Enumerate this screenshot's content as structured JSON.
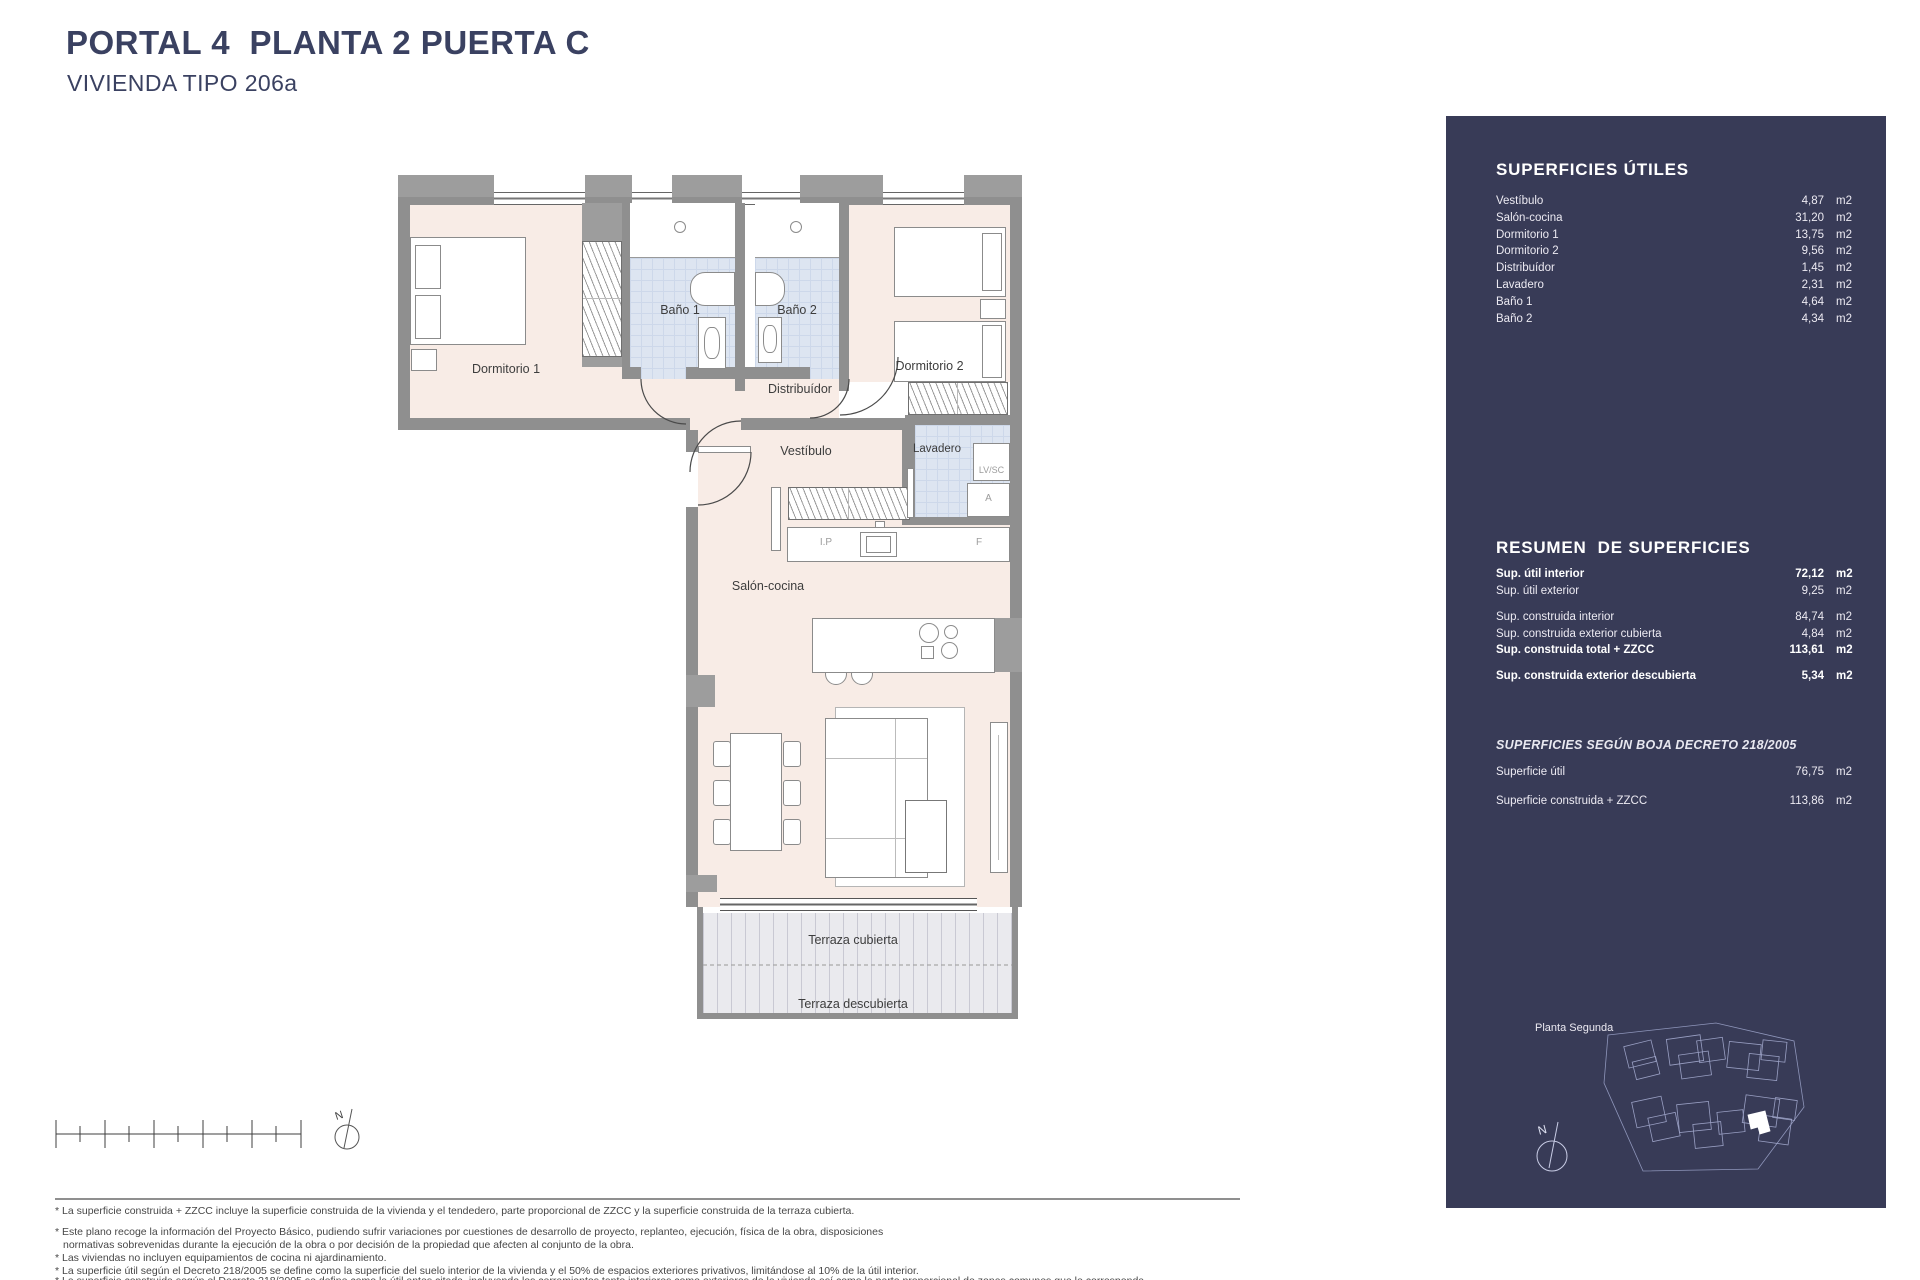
{
  "header": {
    "title": "PORTAL 4  PLANTA 2 PUERTA C",
    "subtitle": "VIVIENDA TIPO 206a"
  },
  "plan": {
    "labels": {
      "dormitorio1": "Dormitorio 1",
      "bano1": "Baño 1",
      "bano2": "Baño 2",
      "dormitorio2": "Dormitorio 2",
      "distribuidor": "Distribuídor",
      "vestibulo": "Vestíbulo",
      "lavadero": "Lavadero",
      "salon_cocina": "Salón-cocina",
      "terraza_cubierta": "Terraza cubierta",
      "terraza_descubierta": "Terraza descubierta",
      "lvsc": "LV/SC",
      "acumulador": "A",
      "induccion": "I.P",
      "frigorifico": "F",
      "north": "N"
    }
  },
  "sidebar": {
    "unit": "m2",
    "utiles": {
      "heading": "SUPERFICIES ÚTILES",
      "rows": [
        {
          "label": "Vestíbulo",
          "value": "4,87"
        },
        {
          "label": "Salón-cocina",
          "value": "31,20"
        },
        {
          "label": "Dormitorio 1",
          "value": "13,75"
        },
        {
          "label": "Dormitorio 2",
          "value": "9,56"
        },
        {
          "label": "Distribuídor",
          "value": "1,45"
        },
        {
          "label": "Lavadero",
          "value": "2,31"
        },
        {
          "label": "Baño 1",
          "value": "4,64"
        },
        {
          "label": "Baño 2",
          "value": "4,34"
        }
      ]
    },
    "resumen": {
      "heading": "RESUMEN  DE SUPERFICIES",
      "rows": [
        {
          "label": "Sup. útil interior",
          "value": "72,12"
        },
        {
          "label": "Sup. útil exterior",
          "value": "9,25"
        },
        {
          "label": "Sup. construida interior",
          "value": "84,74"
        },
        {
          "label": "Sup. construida exterior cubierta",
          "value": "4,84"
        },
        {
          "label": "Sup. construida total + ZZCC",
          "value": "113,61"
        },
        {
          "label": "Sup. construida exterior descubierta",
          "value": "5,34"
        }
      ]
    },
    "boja": {
      "heading": "SUPERFICIES SEGÚN BOJA DECRETO 218/2005",
      "rows": [
        {
          "label": "Superficie útil",
          "value": "76,75"
        },
        {
          "label": "Superficie construida + ZZCC",
          "value": "113,86"
        }
      ]
    },
    "minimap": {
      "label": "Planta Segunda",
      "north": "N"
    }
  },
  "footer": {
    "lines": [
      "* La superficie construida + ZZCC incluye la superficie construida de la vivienda y el tendedero, parte proporcional de ZZCC y la superficie construida de la terraza cubierta.",
      "* Este plano recoge la información del Proyecto Básico, pudiendo sufrir variaciones por cuestiones de desarrollo de proyecto, replanteo, ejecución, física de la obra, disposiciones",
      "normativas sobrevenidas durante la ejecución de la obra o por decisión de la propiedad que afecten al conjunto de la obra.",
      "* Las viviendas no incluyen equipamientos de cocina ni ajardinamiento.",
      "* La superficie útil según el Decreto 218/2005 se define como la superficie del suelo interior de la vivienda y el 50% de espacios exteriores privativos, limitándose al 10% de la útil interior.",
      "* La superficie construida según el Decreto 218/2005 se define como la útil antes citada, incluyendo los cerramientos tanto interiores como exteriores de la vivienda así como la parte proporcional de zonas comunes que le corresponda."
    ]
  },
  "colors": {
    "sidebar_navy": "#383b57",
    "title_navy": "#3a4161",
    "floor_pink": "#f8ece6",
    "tile_blue": "#dde5f1",
    "wall_gray": "#8f8f8f",
    "deck_gray": "#eaeaee"
  }
}
